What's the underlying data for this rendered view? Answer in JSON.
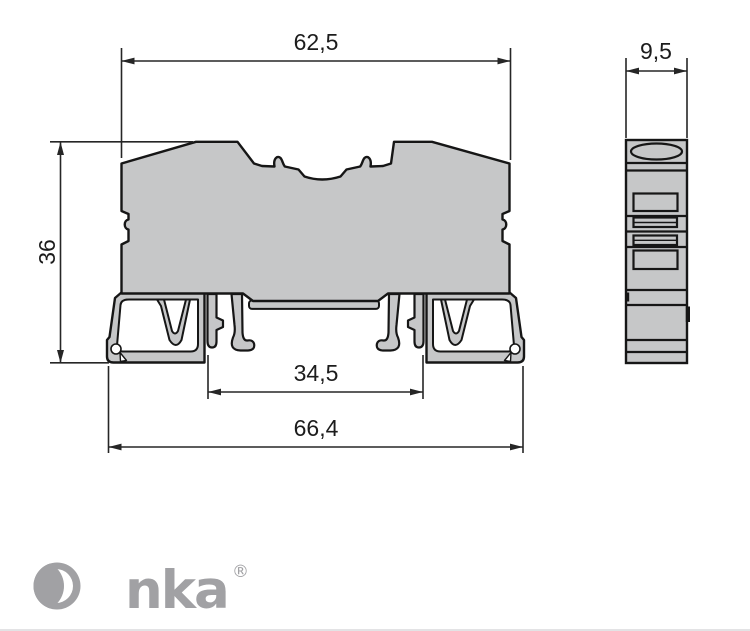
{
  "drawing": {
    "dimension_labels": {
      "front_top_width": "62,5",
      "front_height": "36",
      "rail_channel_width": "34,5",
      "front_bottom_width": "66,4",
      "side_width": "9,5"
    },
    "colors": {
      "body_fill": "#c6c7c8",
      "outline": "#161616",
      "dimension_line": "#262626",
      "text": "#1c1c1c",
      "logo_gray": "#a1a1a4",
      "divider": "#e3e3e5"
    }
  },
  "logo": {
    "brand": "Onka",
    "brand_tail": "nka",
    "registered_mark": "®"
  }
}
